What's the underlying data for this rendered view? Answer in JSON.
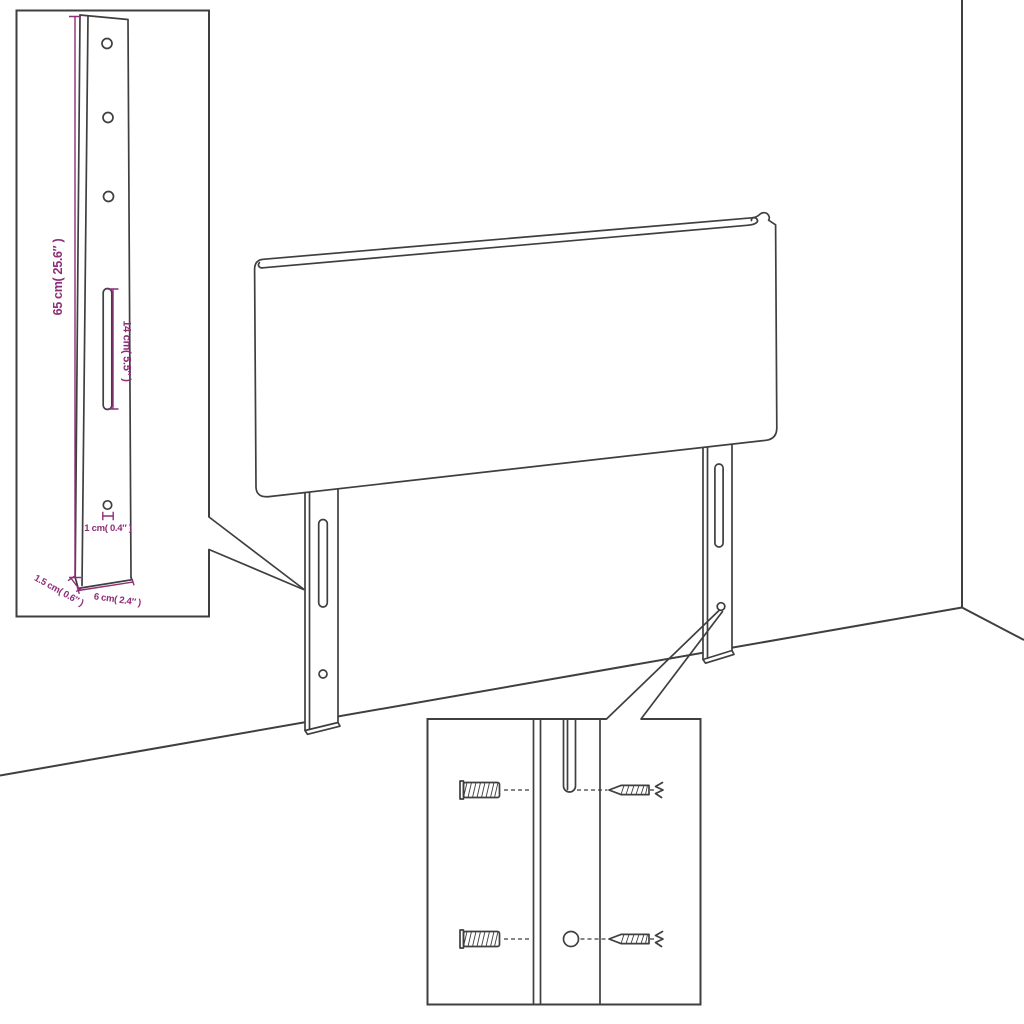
{
  "colors": {
    "outline": "#3f3f3f",
    "dimension": "#8e2d78",
    "background": "#ffffff"
  },
  "inset_bracket": {
    "dim_height": "65 cm( 25.6″ )",
    "dim_slot": "14 cm( 5.5″ )",
    "dim_hole": "1 cm( 0.4″ )",
    "dim_thickness": "1.5 cm( 0.6″ )",
    "dim_width": "6 cm( 2.4″ )"
  },
  "inset_mounting": {
    "parts": [
      "wall-plug",
      "screw",
      "spring-coil"
    ]
  }
}
